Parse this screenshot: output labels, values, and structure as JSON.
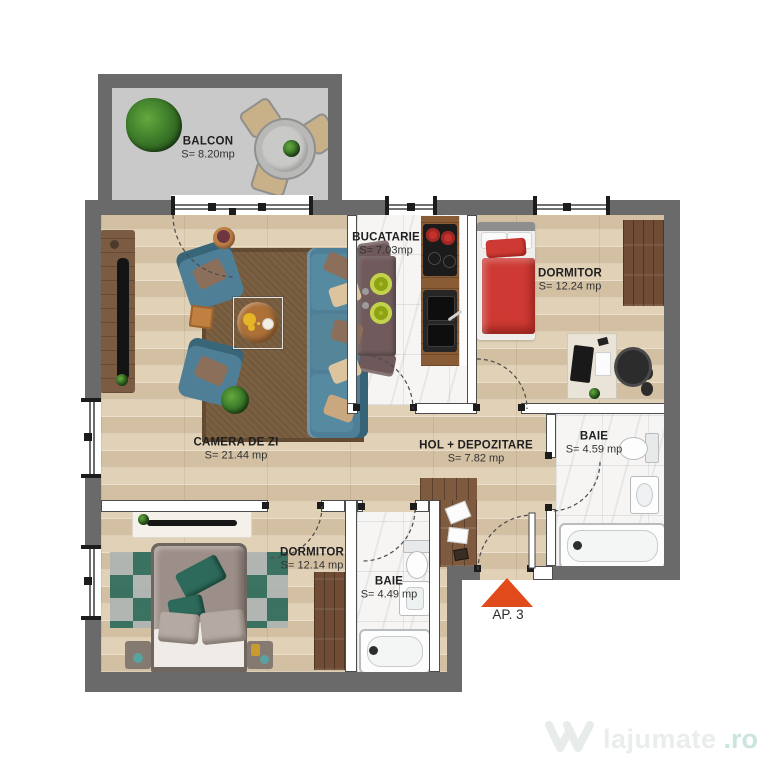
{
  "plan": {
    "title": "Apartment floor plan",
    "rooms": [
      {
        "id": "balcon",
        "name": "BALCON",
        "area": "S= 8.20mp"
      },
      {
        "id": "bucatarie",
        "name": "BUCATARIE",
        "area": "S= 7.03mp"
      },
      {
        "id": "dormitor1",
        "name": "DORMITOR",
        "area": "S= 12.24 mp"
      },
      {
        "id": "camera",
        "name": "CAMERA DE ZI",
        "area": "S= 21.44 mp"
      },
      {
        "id": "hol",
        "name": "HOL + DEPOZITARE",
        "area": "S= 7.82 mp"
      },
      {
        "id": "baie1",
        "name": "BAIE",
        "area": "S= 4.59 mp"
      },
      {
        "id": "dormitor2",
        "name": "DORMITOR",
        "area": "S= 12.14 mp"
      },
      {
        "id": "baie2",
        "name": "BAIE",
        "area": "S= 4.49 mp"
      }
    ],
    "entrance_label": "AP. 3"
  },
  "watermark": {
    "text": "lajumate",
    "suffix": ".ro"
  },
  "colors": {
    "wall": "#6a6a6a",
    "wood": "#ddcdb2",
    "wood_dark": "#7e5a3e",
    "marble": "#f6f5f3",
    "balcony_floor": "#c9c9c9",
    "rug": "#7a5f41",
    "sofa": "#4e7f96",
    "bed_red": "#ce3a33",
    "bed_taupe": "#9c8e88",
    "pillow_green": "#2e6a5b",
    "accent": "#e14a1a",
    "label": "#1f1f1f",
    "watermark_text": "#e9edec",
    "watermark_ro": "#c9e5e0"
  }
}
